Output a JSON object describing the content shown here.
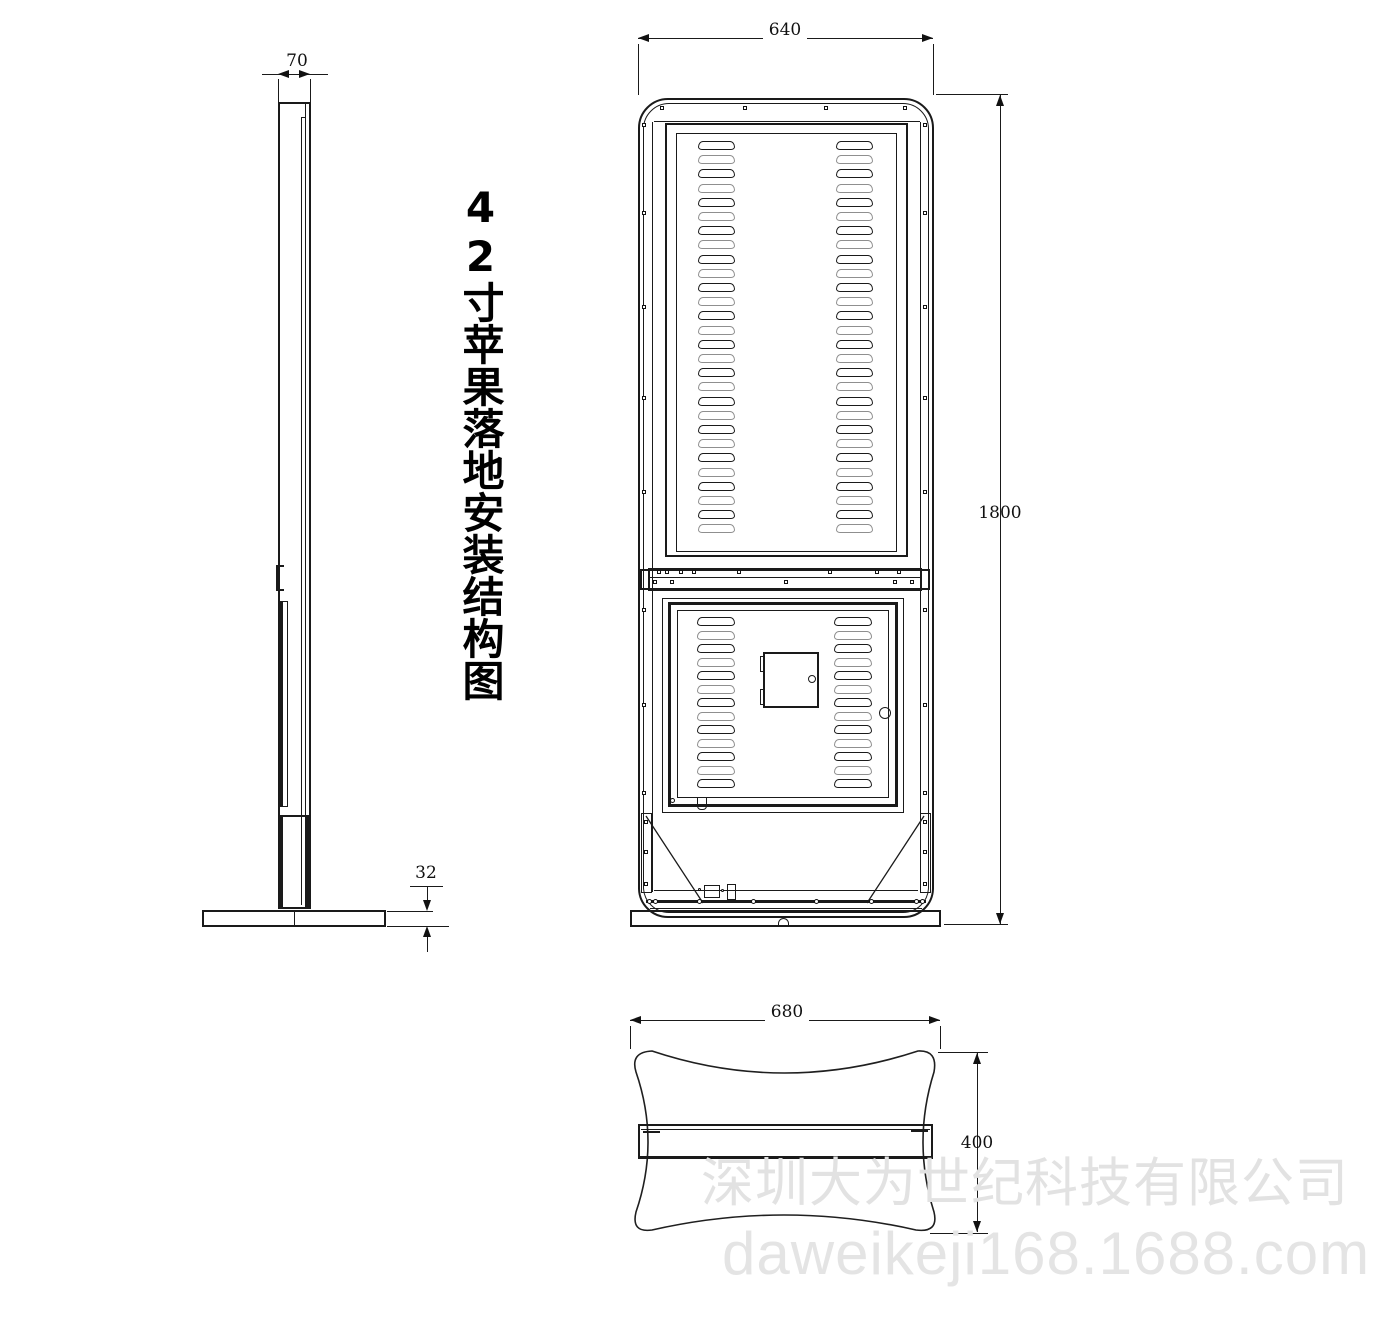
{
  "title": "42寸苹果落地安装结构图",
  "dims": {
    "front_width": "640",
    "overall_height": "1800",
    "side_depth": "70",
    "base_plate_thickness": "32",
    "base_width": "680",
    "base_depth": "400"
  },
  "watermark": {
    "company": "深圳大为世纪科技有限公司",
    "url": "daweikeji168.1688.com"
  },
  "front_view": {
    "upper_vents": {
      "rows": 28,
      "row_top": 141,
      "row_spacing": 14.2,
      "slot_height": 9,
      "slot_width": 37,
      "col_x": [
        698,
        836
      ]
    },
    "lower_vents": {
      "rows": 13,
      "row_top": 617,
      "row_spacing": 13.5,
      "slot_height": 9,
      "slot_width": 38,
      "col_x": [
        697,
        834
      ]
    }
  },
  "colors": {
    "line": "#1a1a1a",
    "watermark": "#e2e2e2",
    "background": "#ffffff"
  }
}
